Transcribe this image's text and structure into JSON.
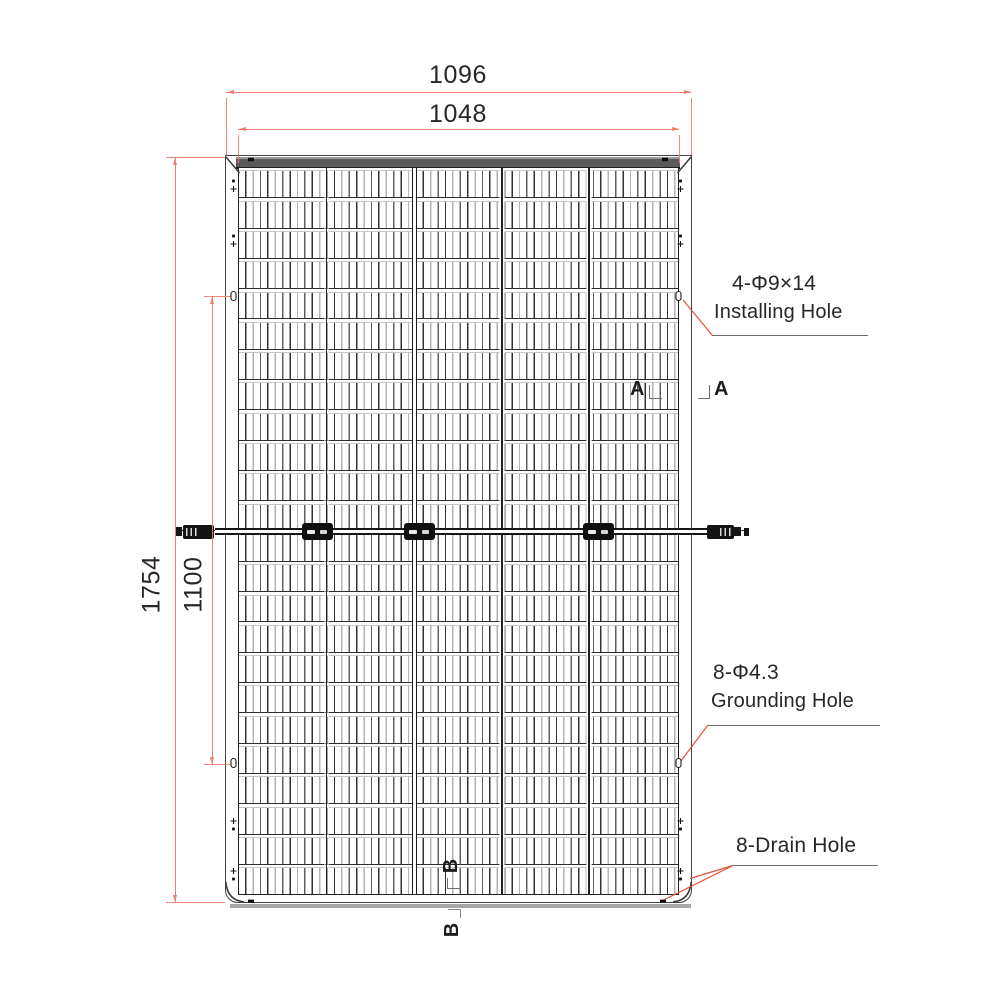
{
  "dimensions": {
    "overall_width_mm": "1096",
    "laminate_width_mm": "1048",
    "overall_height_mm": "1754",
    "mounting_hole_spacing_mm": "1100"
  },
  "annotations": {
    "installing_hole_spec": "4-Φ9×14",
    "installing_hole_label": "Installing Hole",
    "grounding_hole_spec": "8-Φ4.3",
    "grounding_hole_label": "Grounding Hole",
    "drain_hole_label": "8-Drain Hole",
    "section_a": "A",
    "section_b": "B"
  },
  "panel": {
    "cell_rows": 24,
    "cell_columns": 5
  },
  "colors": {
    "dimension_line": "#ef7e71",
    "leader_line": "#e6503c"
  }
}
